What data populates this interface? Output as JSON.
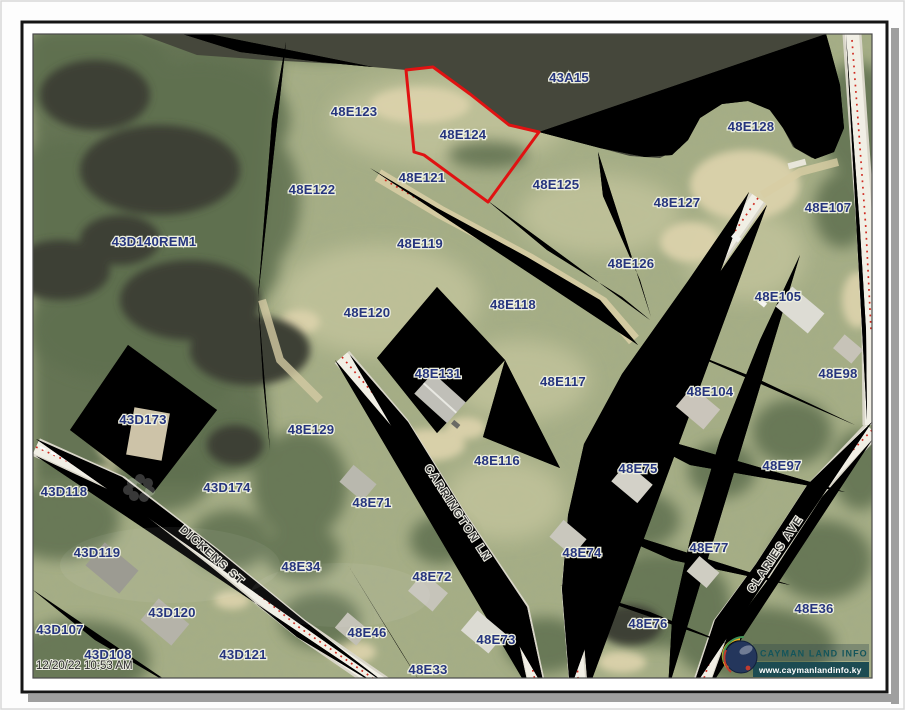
{
  "page": {
    "timestamp": "12/20/22 10:53 AM",
    "logo": {
      "title": "CAYMAN LAND INFO",
      "url": "www.caymanlandinfo.ky"
    }
  },
  "map": {
    "selected_parcel": "48E124",
    "water_label": "43A15",
    "colors": {
      "parcel_line": "#3e7ad0",
      "selected_outline": "#e01212",
      "label_text": "#26357e",
      "water": "#45473b",
      "road": "#f1efe5"
    },
    "parcel_labels": [
      {
        "id": "43A15",
        "x": 569,
        "y": 82
      },
      {
        "id": "48E123",
        "x": 354,
        "y": 116
      },
      {
        "id": "48E124",
        "x": 463,
        "y": 139
      },
      {
        "id": "48E128",
        "x": 751,
        "y": 131
      },
      {
        "id": "48E122",
        "x": 312,
        "y": 194
      },
      {
        "id": "48E121",
        "x": 422,
        "y": 182
      },
      {
        "id": "48E125",
        "x": 556,
        "y": 189
      },
      {
        "id": "48E127",
        "x": 677,
        "y": 207
      },
      {
        "id": "48E107",
        "x": 828,
        "y": 212
      },
      {
        "id": "43D140REM1",
        "x": 154,
        "y": 246
      },
      {
        "id": "48E119",
        "x": 420,
        "y": 248
      },
      {
        "id": "48E126",
        "x": 631,
        "y": 268
      },
      {
        "id": "48E105",
        "x": 778,
        "y": 301
      },
      {
        "id": "48E120",
        "x": 367,
        "y": 317
      },
      {
        "id": "48E118",
        "x": 513,
        "y": 309
      },
      {
        "id": "48E98",
        "x": 838,
        "y": 378
      },
      {
        "id": "48E131",
        "x": 438,
        "y": 378
      },
      {
        "id": "48E117",
        "x": 563,
        "y": 386
      },
      {
        "id": "48E104",
        "x": 710,
        "y": 396
      },
      {
        "id": "43D173",
        "x": 143,
        "y": 424
      },
      {
        "id": "48E129",
        "x": 311,
        "y": 434
      },
      {
        "id": "48E116",
        "x": 497,
        "y": 465
      },
      {
        "id": "48E97",
        "x": 782,
        "y": 470
      },
      {
        "id": "48E75",
        "x": 638,
        "y": 473
      },
      {
        "id": "43D118",
        "x": 64,
        "y": 496
      },
      {
        "id": "43D174",
        "x": 227,
        "y": 492
      },
      {
        "id": "48E71",
        "x": 372,
        "y": 507
      },
      {
        "id": "48E74",
        "x": 582,
        "y": 557
      },
      {
        "id": "48E77",
        "x": 709,
        "y": 552
      },
      {
        "id": "43D119",
        "x": 97,
        "y": 557
      },
      {
        "id": "48E34",
        "x": 301,
        "y": 571
      },
      {
        "id": "48E72",
        "x": 432,
        "y": 581
      },
      {
        "id": "48E36",
        "x": 814,
        "y": 613
      },
      {
        "id": "43D120",
        "x": 172,
        "y": 617
      },
      {
        "id": "48E76",
        "x": 648,
        "y": 628
      },
      {
        "id": "43D107",
        "x": 60,
        "y": 634
      },
      {
        "id": "43D108",
        "x": 108,
        "y": 659
      },
      {
        "id": "43D121",
        "x": 243,
        "y": 659
      },
      {
        "id": "48E46",
        "x": 367,
        "y": 637
      },
      {
        "id": "48E73",
        "x": 496,
        "y": 644
      },
      {
        "id": "48E33",
        "x": 428,
        "y": 674
      }
    ],
    "street_labels": [
      {
        "name": "DICKENS ST",
        "x": 210,
        "y": 558,
        "rot": 42
      },
      {
        "name": "CARRINGTON LN",
        "x": 455,
        "y": 515,
        "rot": 57
      },
      {
        "name": "CLARIES AVE",
        "x": 778,
        "y": 556,
        "rot": -56
      }
    ]
  }
}
